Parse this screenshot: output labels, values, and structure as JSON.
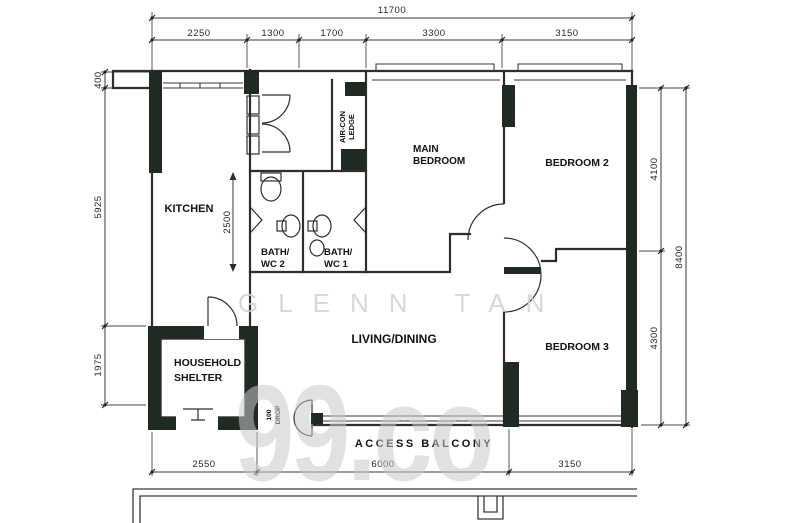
{
  "plan": {
    "rooms": {
      "kitchen": "KITCHEN",
      "main_bedroom": [
        "MAIN",
        "BEDROOM"
      ],
      "bedroom2": "BEDROOM 2",
      "bedroom3": "BEDROOM 3",
      "living": "LIVING/DINING",
      "shelter": [
        "HOUSEHOLD",
        "SHELTER"
      ],
      "bath2": [
        "BATH/",
        "WC 2"
      ],
      "bath1": [
        "BATH/",
        "WC 1"
      ]
    },
    "annotations": {
      "access_balcony": "ACCESS BALCONY",
      "aircon_ledge": [
        "AIR-CON",
        "LEDGE"
      ],
      "drop": [
        "100",
        "DROP"
      ]
    },
    "dims": {
      "total_width": "11700",
      "top": [
        "2250",
        "1300",
        "1700",
        "3300",
        "3150"
      ],
      "left": [
        "400",
        "5925",
        "1975"
      ],
      "inner": "2500",
      "right": [
        "4100",
        "4300"
      ],
      "total_height": "8400",
      "bottom": [
        "2550",
        "6000",
        "3150"
      ]
    }
  },
  "watermarks": {
    "agent_name": "GLENN TAN",
    "brand": "99.co"
  },
  "colors": {
    "wall_fill": "#1f2a22",
    "line": "#2e2e2e",
    "watermark": "#cccccc"
  }
}
